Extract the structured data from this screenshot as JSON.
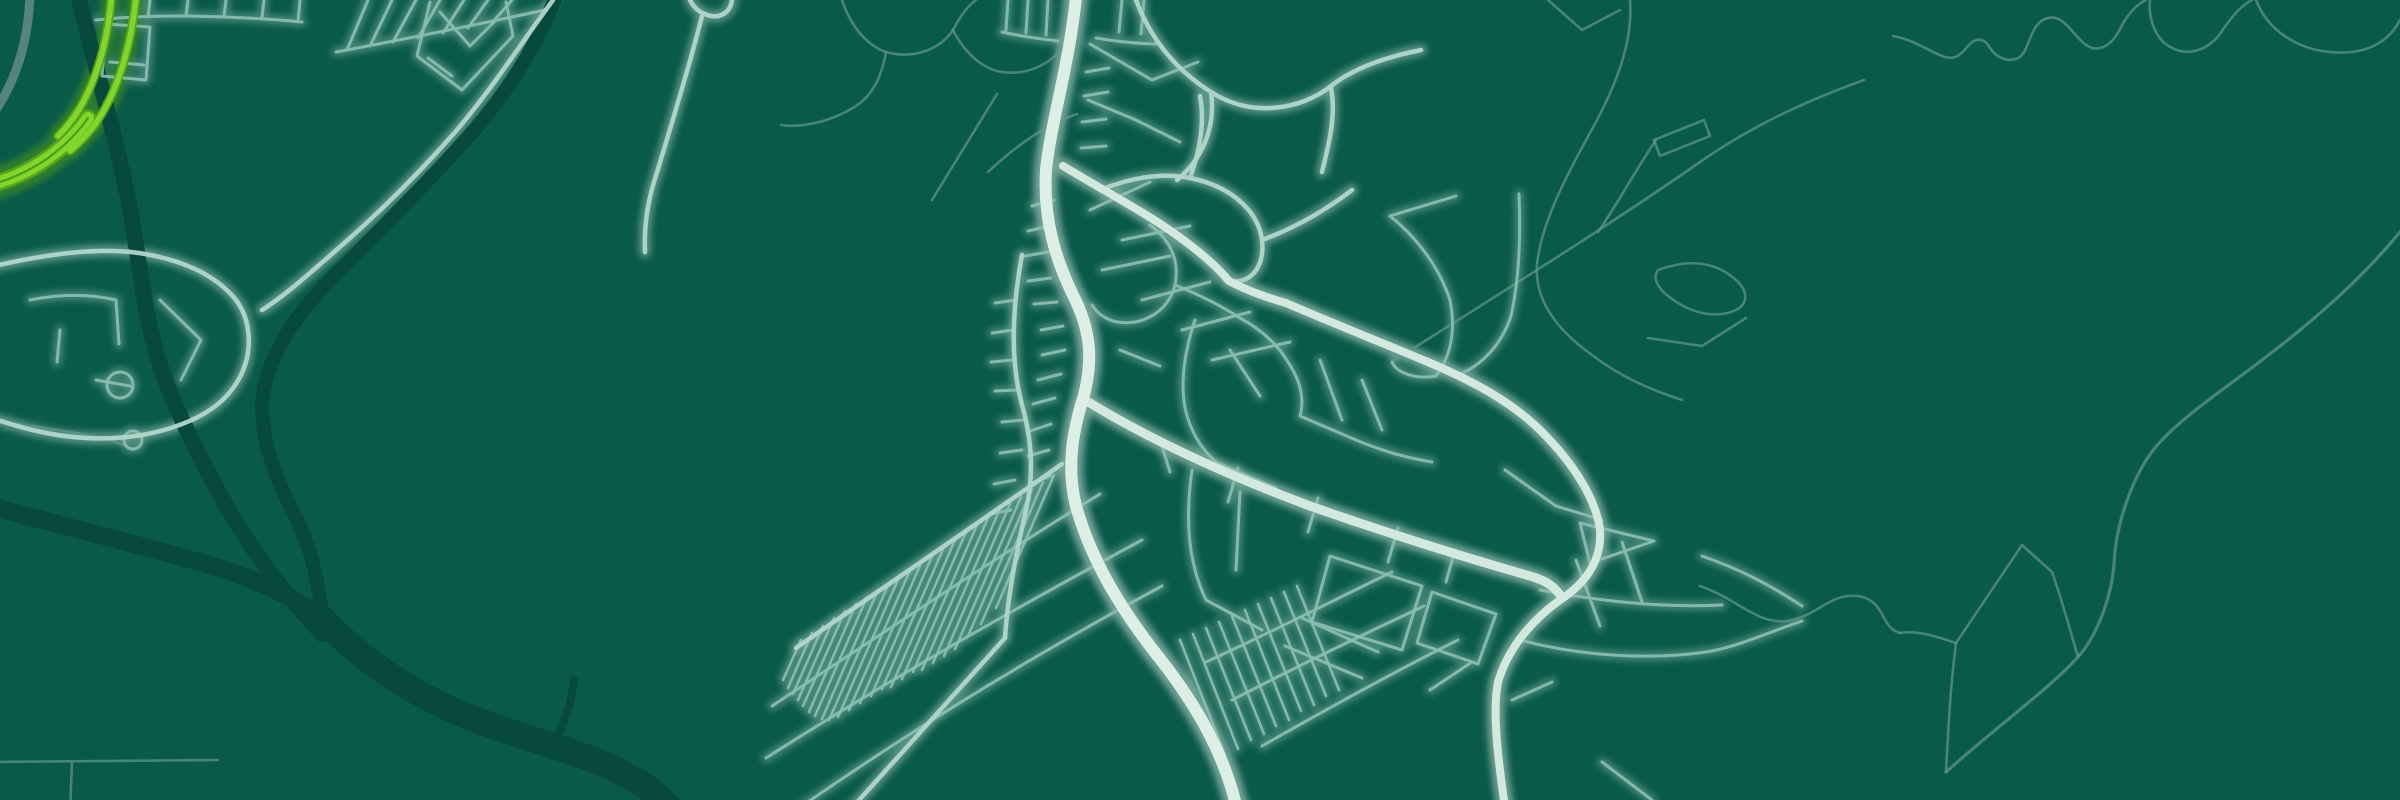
{
  "map": {
    "background_color": "#0a5a4a",
    "water_color": "#07493d",
    "park_color": "#065141",
    "road_faint_color": "#639789",
    "road_minor_color": "#8cbfb1",
    "road_medium_color": "#b2d6ca",
    "road_major_color": "#d3e9e0",
    "road_avenue_color": "#dceee6",
    "road_gray_color": "#56837b",
    "highway_lime_core_color": "#82d52d",
    "highway_lime_casing_color": "#57a516",
    "highway_lime_seam_color": "#4c9a10",
    "layers": [
      {
        "name": "river",
        "kind": "stroke",
        "color": "#07493d",
        "w": 16,
        "op": 1,
        "glow": false,
        "paths": [
          {
            "d": "M 76,-14 C 90,50 118,140 132,220 C 140,268 143,300 153,340 C 163,382 181,420 206,468 C 226,508 256,558 292,600 C 303,613 312,622 322,634",
            "w": 16
          },
          {
            "d": "M 560,-14 C 540,40 510,90 470,135 C 430,180 380,230 336,274 C 301,309 274,344 264,388 C 257,424 270,468 296,518 C 309,544 316,570 322,612",
            "w": 14
          },
          {
            "d": "M -14,505 C 60,525 140,545 206,564 C 252,578 292,594 322,620",
            "w": 18
          },
          {
            "d": "M 320,616 C 360,660 420,700 482,722 C 542,744 592,755 626,775 C 646,786 662,796 674,814",
            "w": 26
          },
          {
            "d": "M 556,740 C 566,718 572,700 574,680",
            "w": 8
          }
        ]
      },
      {
        "name": "water-area",
        "kind": "fill",
        "color": "#07493d",
        "op": 1,
        "paths": [
          {
            "d": "M 1862,682 C 1866,672 1882,668 1898,672 C 1912,675 1916,684 1908,690 C 1896,697 1872,695 1862,688 Z"
          },
          {
            "d": "M 134,304 C 144,298 162,300 168,308 C 172,315 162,321 148,320 C 136,319 128,310 134,304 Z"
          },
          {
            "d": "M 204,326 C 212,321 226,323 230,330 C 233,336 224,341 213,339 C 204,337 199,331 204,326 Z"
          }
        ]
      },
      {
        "name": "park-area",
        "kind": "fill",
        "color": "#065141",
        "op": 1,
        "paths": [
          {
            "d": "M 1138,292 L 1226,300 L 1172,344 Z"
          },
          {
            "d": "M 1150,372 L 1206,390 L 1186,430 L 1140,412 Z"
          },
          {
            "d": "M 1058,518 L 1102,534 L 1080,562 L 1046,546 Z"
          }
        ]
      },
      {
        "name": "road-faint",
        "kind": "stroke",
        "color": "#639789",
        "w": 2.6,
        "op": 0.7,
        "glow": false,
        "paths": [
          {
            "d": "M 1392,362 C 1470,312 1600,232 1700,162 C 1760,120 1820,96 1864,80"
          },
          {
            "d": "M 1598,232 C 1620,200 1638,166 1656,140"
          },
          {
            "d": "M 1654,140 L 1704,120 M 1660,156 L 1710,136 M 1654,140 L 1660,156 M 1704,120 L 1710,136"
          },
          {
            "d": "M 1548,0 L 1582,30 M 1582,30 L 1620,10"
          },
          {
            "d": "M 1630,0 C 1633,40 1618,80 1597,120 C 1567,175 1542,220 1537,264 C 1534,300 1557,330 1592,355 C 1622,378 1652,390 1682,400"
          },
          {
            "d": "M 1658,270 C 1690,258 1718,262 1738,282 C 1748,292 1748,304 1736,310 C 1714,320 1688,312 1668,296 C 1658,288 1652,278 1658,270 Z"
          },
          {
            "d": "M 1648,338 L 1702,346 L 1746,318"
          },
          {
            "d": "M 1893,36 C 1915,40 1930,52 1945,57 C 1958,61 1964,50 1970,44 C 1978,36 1986,40 1990,48 C 1996,57 2006,62 2016,59 C 2026,56 2028,40 2034,30 C 2040,18 2052,14 2062,21 C 2072,28 2080,44 2092,48 C 2104,51 2114,41 2120,29 C 2126,17 2134,6 2146,0"
          },
          {
            "d": "M 2150,0 C 2148,20 2156,40 2172,48 C 2190,57 2210,49 2222,31 C 2230,19 2240,6 2252,0"
          },
          {
            "d": "M 1946,772 C 2000,724 2050,688 2078,657 C 2100,632 2112,592 2114,564 C 2116,520 2136,466 2162,440 C 2192,408 2242,378 2300,330 C 2350,289 2382,254 2400,232",
            "w": 3.2
          },
          {
            "d": "M 1900,633 C 1920,630 1940,638 1956,643 L 2022,545 L 2052,572 C 2062,600 2070,630 2078,657"
          },
          {
            "d": "M 1956,643 C 1950,690 1948,735 1946,772"
          },
          {
            "d": "M 1700,586 C 1738,599 1757,625 1788,621 C 1818,616 1829,593 1858,596 C 1886,600 1880,628 1900,633"
          },
          {
            "d": "M 2256,0 C 2270,36 2308,56 2352,52 C 2384,48 2396,28 2400,20"
          },
          {
            "d": "M 842,0 C 850,25 866,45 886,52 C 916,60 941,48 953,30 C 961,15 969,5 976,0"
          },
          {
            "d": "M 953,30 C 966,56 986,70 1002,72 C 1030,76 1052,62 1064,46"
          },
          {
            "d": "M 886,52 C 881,80 871,96 856,106 C 831,122 801,128 781,125"
          },
          {
            "d": "M 997,94 L 932,200"
          },
          {
            "d": "M 988,172 C 1020,142 1048,124 1077,114"
          },
          {
            "d": "M -14,420 C 30,425 70,432 106,438 L 126,446"
          },
          {
            "d": "M -14,762 L 218,760 M 72,761 L 70,814"
          }
        ]
      },
      {
        "name": "road-minor",
        "kind": "stroke",
        "color": "#8cbfb1",
        "w": 3,
        "op": 0.9,
        "glow": true,
        "paths": [
          {
            "d": "M 96,20 C 150,14 230,15 302,22 M 112,0 L 110,20 M 150,0 L 148,17 M 188,0 L 186,16 M 226,0 L 224,16 M 264,0 L 262,18 M 300,0 L 298,22"
          },
          {
            "d": "M 106,24 L 150,27 L 146,80 L 102,76 Z M 110,62 L 144,65"
          },
          {
            "d": "M 336,52 C 400,40 470,26 545,10 M 368,0 L 347,50 M 392,0 L 370,46 M 416,0 L 393,42 M 440,0 L 418,38 M 464,0 L 443,33 M 488,0 L 468,28 M 512,0 L 492,23"
          },
          {
            "d": "M 430,2 L 417,56 L 462,90 L 513,36 L 506,2 M 440,12 L 470,46 M 470,46 L 494,22 M 428,58 L 452,76"
          },
          {
            "d": "M 30,300 C 60,294 90,294 116,300 M 116,300 L 119,344 M 60,330 L 57,362 M 160,300 L 201,340 M 201,340 L 181,380 M 96,380 L 130,386"
          },
          {
            "d": "M 107,385 a 13,13 0 1 0 26,0 a 13,13 0 1 0 -26,0"
          },
          {
            "d": "M 124,440 a 9,9 0 1 0 18,0 a 9,9 0 1 0 -18,0"
          },
          {
            "d": "M 1008,0 L 1006,30 M 1028,0 L 1026,33 M 1048,0 L 1046,35 M 1002,32 C 1020,36 1040,39 1058,41"
          },
          {
            "d": "M 1122,0 L 1119,32 M 1144,0 L 1141,34 M 1096,38 C 1120,42 1140,44 1160,44"
          },
          {
            "d": "M 1090,44 L 1152,80 M 1152,80 L 1198,62 M 1088,100 L 1136,120 M 1136,120 L 1180,142"
          },
          {
            "d": "M 1150,225 C 1170,240 1180,260 1175,285 C 1170,305 1155,318 1135,322 M 1135,322 C 1115,325 1100,318 1092,305 M 1175,285 C 1200,295 1220,305 1240,318 M 1240,318 C 1262,330 1278,345 1288,362 M 1288,362 C 1300,380 1305,398 1300,416 M 1300,416 L 1356,440 M 1356,440 C 1380,450 1406,458 1432,462 M 1195,320 C 1185,350 1180,380 1185,408 M 1185,408 C 1190,430 1200,448 1216,462 M 1216,462 L 1276,488 M 1120,350 L 1160,366 M 1230,350 L 1260,396 M 1320,360 L 1342,420 M 1362,380 L 1382,430"
          },
          {
            "d": "M 1090,210 L 1150,182 M 1122,240 L 1190,226 M 1102,270 L 1170,256 M 1142,300 L 1210,282 M 1182,330 L 1250,312 M 1212,360 L 1290,342"
          },
          {
            "d": "M 1054,200 l -22,6 M 1050,226 l -22,5 M 1048,252 l -23,4 M 1051,278 l -23,3 M 1057,302 l -23,2 M 1063,326 l -22,4 M 1065,350 l -23,5 M 1061,374 l -23,6 M 1055,398 l -22,6 M 1051,424 l -21,7 M 1049,450 l -21,6 M 1051,476 l -20,7"
          },
          {
            "d": "M 1086,72 l 23,-4 M 1084,96 l 24,-4 M 1082,122 l 24,-3 M 1081,148 l 25,-2"
          },
          {
            "d": "M 1016,300 l -21,3 M 1013,330 l -21,3 M 1013,360 l -22,2 M 1017,390 l -22,1 M 1024,420 l -22,2 M 1022,450 l -22,3 M 1015,480 l -21,4 M 1011,510 l -21,4"
          },
          {
            "d": "M 1390,216 C 1420,240 1440,270 1450,300 M 1450,300 C 1456,330 1451,356 1436,376 M 1436,376 C 1414,380 1396,372 1392,362 M 1390,216 L 1456,196 M 1519,194 C 1521,240 1519,280 1511,316 M 1511,316 C 1501,346 1481,366 1456,376"
          },
          {
            "d": "M 1330,556 L 1422,586 L 1402,650 L 1312,622 Z M 1432,592 L 1496,614 L 1478,664 L 1417,643 Z M 1285,646 L 1362,678 M 1302,618 L 1378,652"
          },
          {
            "d": "M 1160,440 L 1170,472 M 1238,468 L 1228,502 M 1318,498 L 1308,532 M 1398,528 L 1388,562 M 1455,550 L 1446,582"
          },
          {
            "d": "M 1192,470 C 1185,520 1188,562 1206,600 M 1206,600 L 1262,630 M 1240,492 L 1236,570 M 1505,470 L 1556,506 M 1556,506 L 1602,520 M 1430,690 L 1472,662 M 1512,700 L 1552,682 M 1602,762 L 1652,800"
          },
          {
            "d": "M 1580,523 L 1654,541 L 1590,563 Z M 1576,560 L 1600,626 M 1622,542 L 1642,602 M 1540,590 C 1600,601 1660,608 1722,605 M 1520,640 C 1580,656 1652,661 1712,651 C 1742,645 1772,631 1802,621 M 1702,556 C 1742,570 1772,586 1802,606"
          },
          {
            "d": "M 772,706 C 872,640 992,560 1100,494"
          },
          {
            "d": "M 766,758 C 882,684 1012,610 1142,540"
          },
          {
            "d": "M 802,806 C 912,730 1032,656 1162,586"
          },
          {
            "d": "M 1206,662 C 1272,632 1334,600 1392,572 M 1232,700 C 1302,664 1364,634 1424,606 M 1262,746 C 1332,706 1398,670 1458,640"
          },
          {
            "d": "M 801,640 l -18,40 M 812,633 l -24,55 M 823,626 l -30,68 M 834,618 l -36,82 M 845,611 l -42,95 M 856,604 l -47,108 M 867,597 l -52,119 M 878,590 l -56,129 M 889,583 l -60,137 M 900,575 l -62,142 M 911,568 l -62,142 M 922,561 l -62,142 M 933,554 l -62,142 M 944,547 l -62,142 M 955,540 l -64,147 M 966,532 l -64,147 M 977,525 l -64,147 M 988,518 l -66,152 M 999,511 l -66,152 M 1010,504 l -66,152 M 1021,497 l -66,152 M 1032,489 l -64,147 M 1043,482 l -62,142 M 1054,475 l -58,133",
            "w": 2.6
          },
          {
            "d": "M 1180,640 l 45,115 M 1193,634 l 45,115 M 1206,628 l 45,112 M 1219,622 l 45,112 M 1232,616 l 44,110 M 1245,610 l 44,110 M 1258,604 l 43,107 M 1271,598 l 43,107 M 1284,592 l 42,104 M 1297,586 l 42,104",
            "w": 2.6
          }
        ]
      },
      {
        "name": "road-medium",
        "kind": "stroke",
        "color": "#b2d6ca",
        "w": 4.5,
        "op": 0.95,
        "glow": true,
        "paths": [
          {
            "d": "M 1005,638 L 852,808"
          },
          {
            "d": "M 796,648 C 880,590 980,522 1062,464"
          },
          {
            "d": "M 553,0 C 520,45 491,90 456,131 C 421,171 381,211 341,246 C 311,272 286,295 262,310"
          },
          {
            "d": "M -14,268 C 40,255 90,248 131,252 C 181,258 216,275 236,300 C 251,320 253,350 241,375 C 231,395 216,408 196,418 C 161,435 121,440 86,438 C 51,436 20,428 -14,416"
          },
          {
            "d": "M 1100,190 C 1130,178 1160,172 1190,178 C 1230,186 1258,210 1262,240 C 1265,268 1250,284 1230,281 M 1190,178 C 1200,150 1205,122 1200,96 M 1262,240 C 1292,229 1322,213 1352,190 M 1322,172 C 1330,140 1336,114 1331,88"
          },
          {
            "d": "M 1136,0 C 1151,40 1176,70 1211,92 C 1251,118 1301,110 1331,86 C 1356,66 1391,56 1421,50 M 1211,92 C 1216,130 1201,160 1177,180"
          },
          {
            "d": "M 1022,255 C 1012,310 1010,360 1022,405 C 1032,440 1034,476 1026,510 C 1018,545 1008,592 1005,638"
          },
          {
            "d": "M 690,0 C 694,8 701,14 711,16 C 723,18 731,10 732,0 M 702,16 C 691,60 673,120 654,182 C 647,205 644,228 645,252"
          }
        ]
      },
      {
        "name": "road-major",
        "kind": "stroke",
        "color": "#d3e9e0",
        "w": 8,
        "op": 1,
        "glow": true,
        "paths": [
          {
            "d": "M 1063,166 C 1096,186 1126,202 1159,223 C 1191,244 1213,262 1229,281 C 1250,292 1269,298 1286,303"
          },
          {
            "d": "M 1286,303 C 1330,322 1380,342 1428,362 C 1470,380 1510,400 1542,432 C 1572,462 1596,498 1600,530 C 1602,558 1588,582 1560,600 C 1532,620 1508,648 1498,682 C 1492,712 1498,760 1506,814"
          },
          {
            "d": "M 1085,400 C 1150,440 1230,476 1310,506 C 1390,534 1460,556 1530,576 C 1548,581 1556,588 1562,598",
            "w": 9
          }
        ]
      },
      {
        "name": "road-avenue",
        "kind": "stroke",
        "color": "#dceee6",
        "w": 12,
        "op": 1,
        "glow": true,
        "paths": [
          {
            "d": "M 1077,-14 C 1071,60 1051,120 1046,170 C 1043,220 1056,260 1073,295 C 1091,330 1093,360 1084,395 C 1073,430 1066,466 1076,506 C 1091,560 1121,610 1161,660 C 1196,705 1226,755 1238,814"
          }
        ]
      },
      {
        "name": "road-gray",
        "kind": "stroke",
        "color": "#56837b",
        "w": 9,
        "op": 1,
        "glow": false,
        "paths": [
          {
            "d": "M 30,-14 C 30,40 16,85 -14,124"
          }
        ]
      },
      {
        "name": "highway-lime-casing",
        "kind": "stroke",
        "color": "#57a516",
        "w": 9,
        "op": 1,
        "glow": true,
        "paths": [
          {
            "d": "M 112,-14 C 110,30 100,72 81,106 C 74,118 66,128 58,136",
            "w": 9
          },
          {
            "d": "M 137,-14 C 133,40 119,92 93,127 C 86,136 78,144 70,151",
            "w": 9
          },
          {
            "d": "M 88,118 C 74,138 54,156 32,168 C 18,176 2,182 -14,186",
            "w": 17
          }
        ]
      },
      {
        "name": "highway-lime-core",
        "kind": "stroke",
        "color": "#82d52d",
        "w": 5.5,
        "op": 1,
        "glow": false,
        "paths": [
          {
            "d": "M 112,-14 C 110,30 100,72 81,106 C 74,118 66,128 58,136",
            "w": 5.5
          },
          {
            "d": "M 137,-14 C 133,40 119,92 93,127 C 86,136 78,144 70,151",
            "w": 5.5
          },
          {
            "d": "M 88,118 C 74,138 54,156 32,168 C 18,176 2,182 -14,186",
            "w": 12
          }
        ]
      },
      {
        "name": "highway-lime-seam",
        "kind": "stroke",
        "color": "#4c9a10",
        "w": 2,
        "op": 1,
        "glow": false,
        "paths": [
          {
            "d": "M 88,118 C 74,138 54,156 32,168 C 18,176 2,182 -14,186",
            "w": 2
          }
        ]
      }
    ]
  }
}
